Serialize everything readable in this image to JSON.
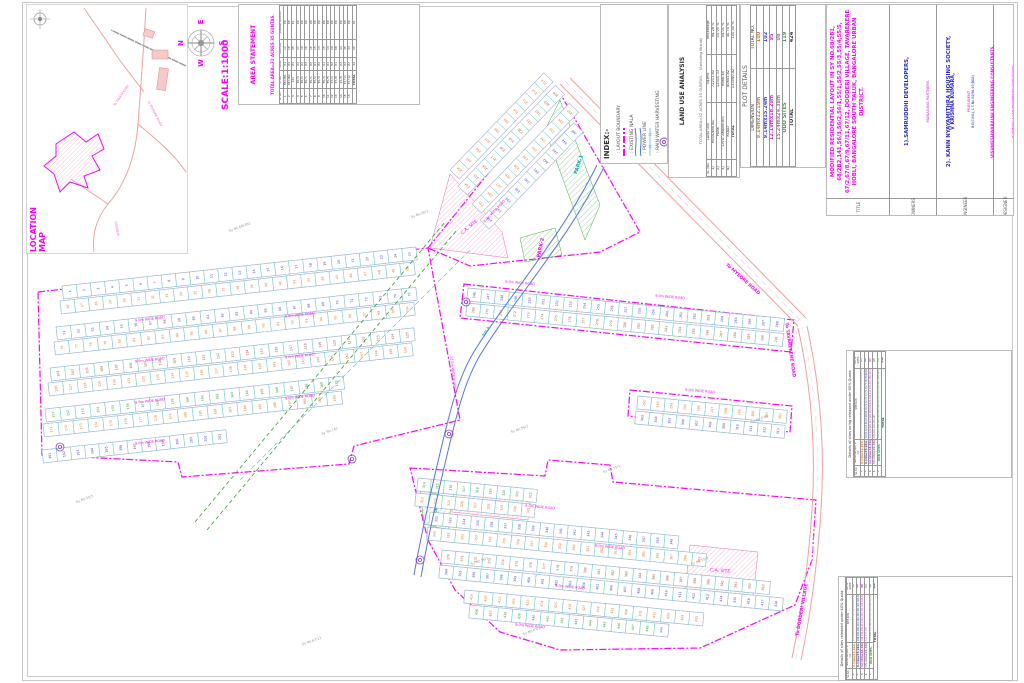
{
  "location_map": {
    "title": "LOCATION MAP",
    "road_names": [
      "To MYSORE ROAD",
      "To TAVAREKERE",
      "DODDERI"
    ]
  },
  "compass": {
    "n": "N",
    "e": "E",
    "s": "S",
    "w": "W",
    "scale": "SCALE:1:1000"
  },
  "area_statement": {
    "title": "AREA STATEMENT",
    "subtitle": "TOTAL AREA=32 ACRES 35 GUNTAS.",
    "columns": [
      "SL NO",
      "SY NO",
      "ACRE",
      "GUNTAS",
      "KHARAB GUNTAS"
    ],
    "col_group": "AREA IN",
    "rows": [
      [
        "1",
        "68/2B1",
        "01",
        "12",
        "00"
      ],
      [
        "2",
        "68/2B2",
        "03",
        "18",
        "00"
      ],
      [
        "3",
        "141",
        "04",
        "35",
        "01"
      ],
      [
        "4",
        "56/3",
        "02",
        "27",
        "00"
      ],
      [
        "5",
        "56/2",
        "02",
        "10",
        "00"
      ],
      [
        "6",
        "56/1",
        "03",
        "28",
        "00"
      ],
      [
        "7",
        "55/1",
        "02",
        "16",
        "00"
      ],
      [
        "8",
        "55/2",
        "01",
        "15",
        "00"
      ],
      [
        "9",
        "55/3",
        "02",
        "13",
        "00"
      ],
      [
        "10",
        "55/4",
        "01",
        "15",
        "00"
      ],
      [
        "11",
        "55/5",
        "01",
        "13",
        "00"
      ],
      [
        "12",
        "67/2",
        "02",
        "20",
        "00"
      ],
      [
        "13",
        "67/8",
        "01",
        "08",
        "00"
      ],
      [
        "14",
        "67/9",
        "02",
        "34",
        "00"
      ],
      [
        "15",
        "67/11",
        "03",
        "35",
        "00"
      ],
      [
        "16",
        "67/12",
        "02",
        "34",
        "00"
      ]
    ],
    "total": [
      "",
      "TOTAL",
      "32",
      "35",
      "01"
    ]
  },
  "index_legend": {
    "title": "INDEX:-",
    "items": [
      {
        "symbol": "layout-boundary",
        "label": "LAYOUT  BOUNDARY",
        "color": "#ff00ff"
      },
      {
        "symbol": "existing-nala",
        "label": "EXISTING  NALA",
        "color": "#5577dd"
      },
      {
        "symbol": "power-line",
        "label": "POWER  LINE",
        "color": "#66bbdd"
      },
      {
        "symbol": "rain-water",
        "label": "RAIN  WATER  HARVESTING",
        "color": "#8844cc"
      }
    ]
  },
  "land_use": {
    "title": "LAND USE ANALYSIS",
    "subtitle1": "TOTAL AREA=32 ACRES 35 GUNTAS.",
    "subtitle2": "(Excluding Kharab)",
    "columns": [
      "SL NO.",
      "LAND USE",
      "Sq.mtr",
      "Percentage"
    ],
    "rows": [
      [
        "1)",
        "RESIDENTIAL",
        "72217.82",
        "54.28 %"
      ],
      [
        "2)",
        "PARK",
        "13310.33",
        "10.00 %"
      ],
      [
        "3)",
        "CIVIC AMENITIES",
        "6668.45",
        "05.01 %"
      ],
      [
        "4)",
        "ROAD",
        "40843.82",
        "30.70 %"
      ]
    ],
    "total": [
      "",
      "TOTAL",
      "133040.42",
      "100.00 %"
    ]
  },
  "plot_details": {
    "title": "PLOT DETAILS",
    "columns": [
      "DIMENSION",
      "TOTAL NO."
    ],
    "rows": [
      {
        "dim": "9.14mx12.19m",
        "no": "100",
        "color": "#e07818"
      },
      {
        "dim": "9.14mx15.24m",
        "no": "102",
        "color": "#3a3ae0"
      },
      {
        "dim": "12.19mx18.29m",
        "no": "95",
        "color": "#cc22cc"
      },
      {
        "dim": "15.24mx24.38m",
        "no": "08",
        "color": "#888888"
      },
      {
        "dim": "ODD SITES",
        "no": "119",
        "color": "#2e9e2e"
      }
    ],
    "total": {
      "dim": "TOTAL",
      "no": "424"
    }
  },
  "title_block": {
    "title_label": "TITLE",
    "title_text": "MODIFIED RESIDENTIAL LAYOUT IN SY NO.68/2B1, 68/2B2,141,56/3,56/2,56/1,55/1,55/2,55/3,55/4,55/5, 67/2,67/8,67/9,67/11,67/12, DODDERI VILLAGE, TAVAREKERE HOBLI, BANGALORE SOUTH TALUK, BANGALORE URBAN DISTRICT.",
    "owners_label": "OWNERS",
    "owner1": "1).SAMRUDDHI DEVELOPERS,",
    "owner1_sub": "MANAGING PARTNERS",
    "owner2": "2). KANN  NYAYAMITHRA HOUSING SOCIETY,",
    "owner2_sub": "PRESIDENT",
    "engineer_label": "ENGINEER",
    "engineer_name": "V KRISHNA KUMARA,",
    "engineer_qual": "B.E(CIVIL), L.S No.04/96-97(BDA)",
    "firm": "VISHWESHWARAIAH ENGINEERING CONSULTANTS,",
    "firm_sub": "(SURVEYING & CIVIL ENGINEERING CONSULTANTS)",
    "firm_addr1": "'Vinoda' Building No.71, 2nd Floor, 7th Cross,",
    "firm_addr2": "Nandini Layout, Bangalore-560 096.",
    "firm_addr3": "MOBILE NO.99451 72879, 98441 94550",
    "designer_label": "DESIGNER"
  },
  "release_tables": [
    {
      "title": "Details of sites being released under 60% Quota",
      "columns": [
        "SL NO",
        "Site Dimension in mtr",
        "SITE NOS",
        "NO OF SITES"
      ],
      "rows": [
        {
          "sl": "1.",
          "dim": "9.14mx12.19m",
          "color": "#e07818",
          "site_nos": "1,2,3,4,5,6,7,8,9,10,11,12,13,14,15,16,17,18,19,20,21,22,23,24,25,26,27,28,29,30,31,32,33,34,35,36,37,38,39,40,41,42,43,44,45,46,47,48,49,50,51,52,53,54,55,56,57,58,59,60,61",
          "count": "61"
        },
        {
          "sl": "2.",
          "dim": "9.14mx15.24m",
          "color": "#3a3ae0",
          "site_nos": "62,63,64,65,66,67,68,69,70,71,72,73,74,75,76,77,78,79,80,81,82,83,84,85,86,87,88,89,90,91,92,93,94,95,96,97,98,99,100,101,102,103,104,105,106,107,108,109,110,111,112,113,114,115,116,117,118,119,120,121,122,123",
          "count": "62"
        },
        {
          "sl": "3.",
          "dim": "12.19mx18.29m",
          "color": "#cc22cc",
          "site_nos": "124,125,126,127,128,129,130,131,132,133,134,135,136,137,138,139,140,141,142,143,144,145,146,147,148,149,150,151,152,153,154,155,156,157,158,159,160,161,162,163,164,165,166,167,168,169,170,171,172,173,174,175,176,177,178,179,180",
          "count": "57"
        },
        {
          "sl": "4.",
          "dim": "15.24mx24.38m",
          "color": "#888888",
          "site_nos": "181,182,183,184,185",
          "count": "05"
        },
        {
          "sl": "5.",
          "dim": "ODD SITES",
          "color": "#2e9e2e",
          "site_nos": "186,187,188,189,190,191,192,193,194,195,196,197,198,199,200,201,202,203,204,205,206,207,208,209,210,211,212,213,214,215,216,217,218,219,220,221,222,223,224,225,226,227,228,229,230,231,232,233,234,235,236,237,238,239,240,241,242,243,244,245,246,247,248,249,250,251,252,253,254,255,256,257,258",
          "count": "73"
        }
      ],
      "total_label": "TOTAL",
      "total": "258"
    },
    {
      "title": "Details of sites released under 40% Quota",
      "columns": [
        "SL NO",
        "Site Dimension in mtr",
        "SITE NOS",
        "NO OF SITES"
      ],
      "rows": [
        {
          "sl": "1.",
          "dim": "9.14mx12.19m",
          "color": "#e07818",
          "site_nos": "259,260,261,262,263,264,265,266,267,268,269,270,271,272,273,274,275,276,277,278,279,280,281,282,283,284,285,286,287,288,289,290,291,292,293,294,295,296,297",
          "count": "39"
        },
        {
          "sl": "2.",
          "dim": "9.14mx15.24m",
          "color": "#3a3ae0",
          "site_nos": "298,299,300,301,302,303,304,305,306,307,308,309,310,311,312,313,314,315,316,317,318,319,320,321,322,323,324,325,326,327,328,329,330,331,332,333,334,335,336,337",
          "count": "40"
        },
        {
          "sl": "3.",
          "dim": "12.19mx18.29m",
          "color": "#cc22cc",
          "site_nos": "338,339,340,341,342,343,344,345,346,347,348,349,350,351,352,353,354,355,356,357,358,359,360,361,362,363,364,365,366,367,368,369,370,371,372,373,374,375",
          "count": "38"
        },
        {
          "sl": "4.",
          "dim": "15.24mx24.38m",
          "color": "#888888",
          "site_nos": "376,377,378",
          "count": "03"
        },
        {
          "sl": "5.",
          "dim": "ODD SITES",
          "color": "#2e9e2e",
          "site_nos": "379,380,381,382,383,384,385,386,387,388,389,390,391,392,393,394,395,396,397,398,399,400,401,402,403,404,405,406,407,408,409,410,411,412,413,414,415,416,417,418,419,420,421,422,423,424",
          "count": "46"
        }
      ],
      "total_label": "TOTAL",
      "total": "166"
    }
  ],
  "map": {
    "road_label": "9.0m WIDE ROAD",
    "main_road_label": "12.0m WIDE ROAD",
    "nala_label": "NALA",
    "ca_label": "C.A. SITE",
    "park_labels": [
      "PARK-1",
      "PARK-2",
      "PARK-3"
    ],
    "edge_labels": [
      {
        "t": "To MYSORE ROAD",
        "x": 742,
        "y": 280,
        "r": 42,
        "c": "#ff00ff"
      },
      {
        "t": "To DODDERI VILLAGE",
        "x": 803,
        "y": 610,
        "r": -80,
        "c": "#ff00ff"
      },
      {
        "t": "To TAVAREKERE ROAD",
        "x": 789,
        "y": 350,
        "r": 82,
        "c": "#ff00ff"
      }
    ],
    "sy_labels": [
      {
        "t": "Sy No.68/2B1",
        "x": 240,
        "y": 228
      },
      {
        "t": "Sy No.141",
        "x": 330,
        "y": 432
      },
      {
        "t": "Sy No.56/3",
        "x": 520,
        "y": 430
      },
      {
        "t": "Sy No.56/1",
        "x": 480,
        "y": 562
      },
      {
        "t": "Sy No.55/1",
        "x": 612,
        "y": 470
      },
      {
        "t": "Sy No.55/3",
        "x": 700,
        "y": 562
      },
      {
        "t": "Sy No.67/2",
        "x": 532,
        "y": 632
      },
      {
        "t": "Sy No.67/9",
        "x": 760,
        "y": 420
      },
      {
        "t": "Sy No.56/2",
        "x": 420,
        "y": 215
      },
      {
        "t": "Sy No.55/5",
        "x": 85,
        "y": 500
      },
      {
        "t": "Sy No.67/12",
        "x": 312,
        "y": 642
      }
    ],
    "plot_strips": [
      [
        62,
        286,
        356,
        -6.3,
        25,
        "#3a3ae0"
      ],
      [
        60,
        301,
        356,
        -6.3,
        25,
        "#e07818"
      ],
      [
        56,
        327,
        362,
        -6.3,
        25,
        "#3a3ae0"
      ],
      [
        54,
        342,
        362,
        -6.3,
        25,
        "#e07818"
      ],
      [
        50,
        368,
        366,
        -6.3,
        25,
        "#a05a2c"
      ],
      [
        48,
        383,
        366,
        -6.3,
        25,
        "#e07818"
      ],
      [
        45,
        409,
        300,
        -6.3,
        20,
        "#2e9e2e"
      ],
      [
        43,
        424,
        300,
        -6.3,
        20,
        "#e07818"
      ],
      [
        42,
        450,
        185,
        -6.3,
        13,
        "#3a3ae0"
      ],
      [
        450,
        170,
        135,
        -46,
        10,
        "#e07818"
      ],
      [
        458,
        186,
        140,
        -46,
        11,
        "#a05a2c"
      ],
      [
        472,
        204,
        140,
        -46,
        11,
        "#e07818"
      ],
      [
        480,
        220,
        135,
        -46,
        10,
        "#3a3ae0"
      ],
      [
        468,
        288,
        318,
        5.5,
        23,
        "#3a3ae0"
      ],
      [
        467,
        303,
        318,
        5.5,
        23,
        "#a05a2c"
      ],
      [
        638,
        396,
        150,
        5.5,
        11,
        "#e07818"
      ],
      [
        636,
        411,
        150,
        5.5,
        11,
        "#3a3ae0"
      ],
      [
        418,
        478,
        120,
        5.5,
        9,
        "#2e9e2e"
      ],
      [
        416,
        493,
        120,
        5.5,
        9,
        "#e07818"
      ],
      [
        430,
        512,
        250,
        5.5,
        18,
        "#3a3ae0"
      ],
      [
        428,
        527,
        280,
        5.5,
        20,
        "#e07818"
      ],
      [
        442,
        550,
        330,
        5.5,
        24,
        "#a05a2c"
      ],
      [
        440,
        565,
        345,
        5.5,
        25,
        "#3a3ae0"
      ],
      [
        465,
        590,
        240,
        5.5,
        17,
        "#e07818"
      ],
      [
        470,
        605,
        200,
        5.5,
        14,
        "#2e9e2e"
      ]
    ],
    "road_label_pos": [
      [
        150,
        320,
        -6.3
      ],
      [
        300,
        316,
        -6.3
      ],
      [
        150,
        361,
        -6.3
      ],
      [
        300,
        357,
        -6.3
      ],
      [
        150,
        402,
        -6.3
      ],
      [
        300,
        398,
        -6.3
      ],
      [
        150,
        443,
        -6.3
      ],
      [
        520,
        284,
        5.5
      ],
      [
        670,
        298,
        5.5
      ],
      [
        700,
        392,
        5.5
      ],
      [
        540,
        508,
        5.5
      ],
      [
        610,
        548,
        5.5
      ],
      [
        570,
        588,
        5.5
      ],
      [
        530,
        627,
        5.5
      ],
      [
        495,
        212,
        -46
      ]
    ]
  }
}
